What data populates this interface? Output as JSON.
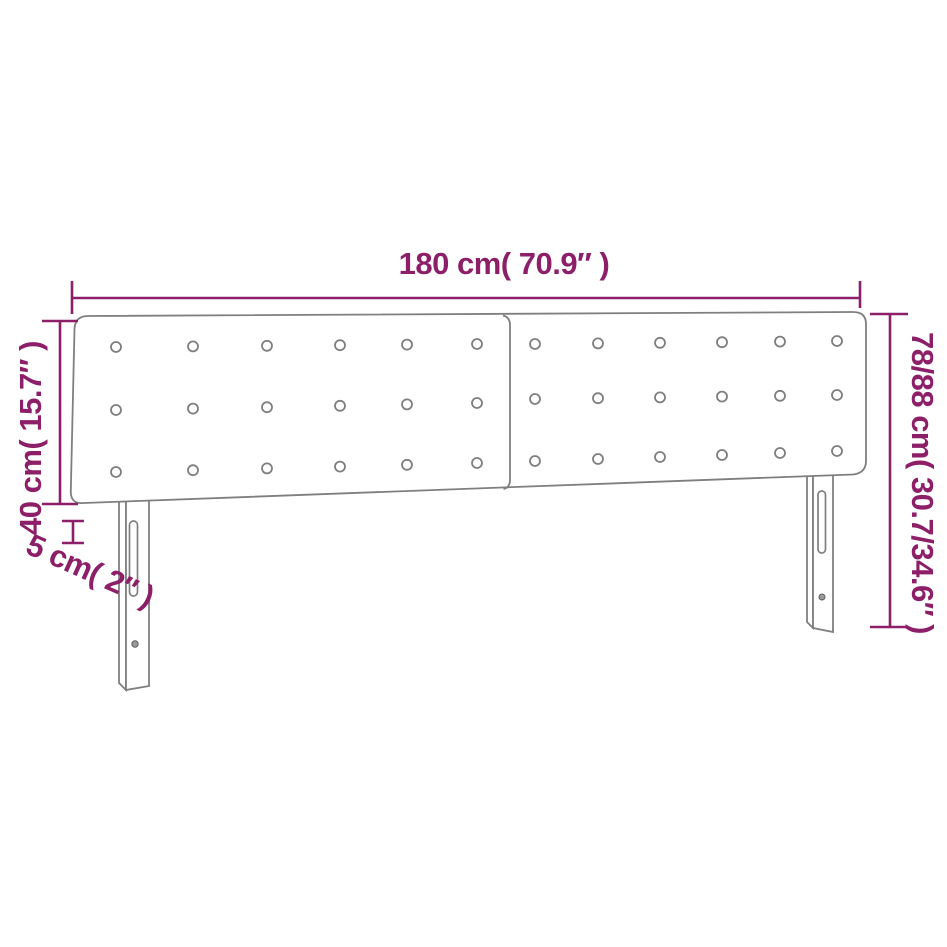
{
  "diagram": {
    "type": "product-dimension-diagram",
    "product": "upholstered-headboard-with-two-panels-and-two-legs",
    "measurements": {
      "width": "180 cm( 70.9″ )",
      "panel_height": "40 cm( 15.7″ )",
      "thickness": "5 cm( 2″ )",
      "total_height": "78/88 cm( 30.7/34.6″ )"
    },
    "colors": {
      "dimension": "#8C1F68",
      "outline": "#7f7f7f",
      "background": "#ffffff"
    },
    "structure": {
      "panels": 2,
      "button_rows": 3,
      "buttons_per_panel_row": 6,
      "legs": 2,
      "slots_per_leg": 1,
      "screws_per_leg": 1
    }
  }
}
